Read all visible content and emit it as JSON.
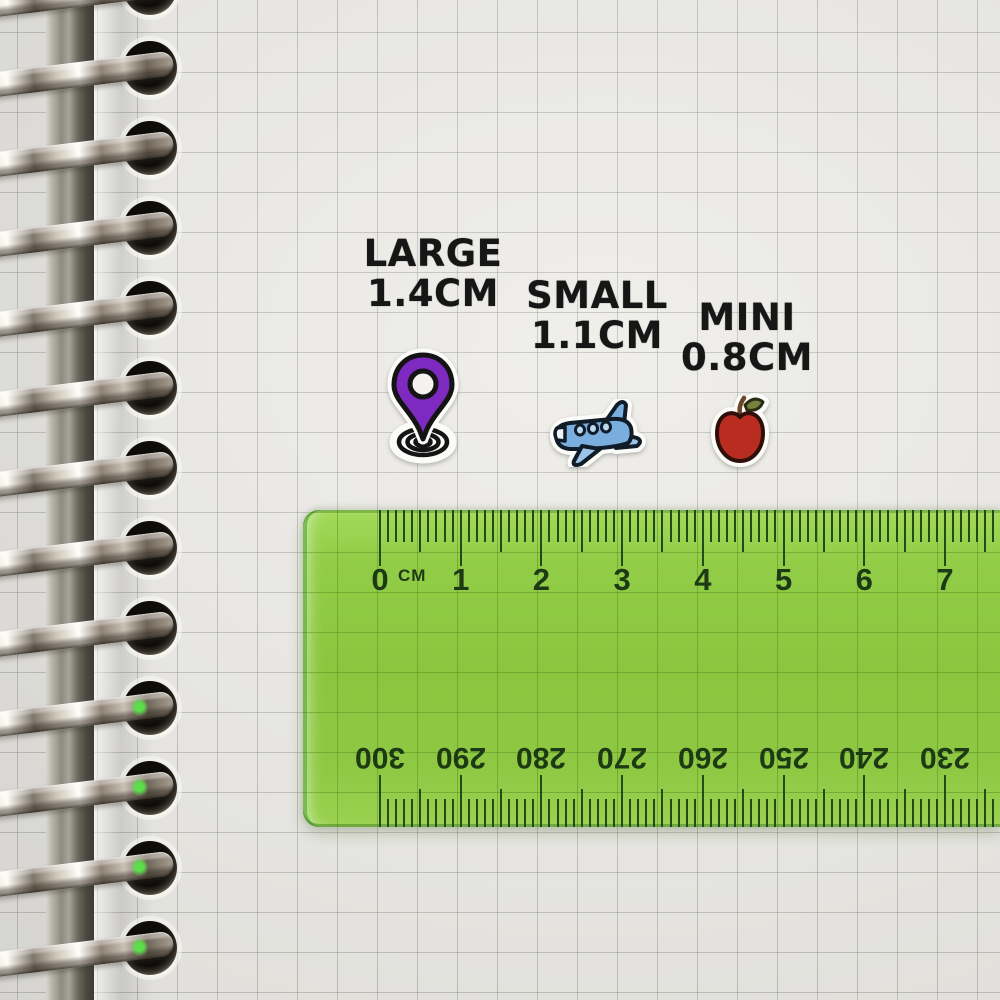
{
  "scene_title": "Sticker size comparison on squared notebook page with green ruler",
  "size_labels": [
    {
      "title": "LARGE",
      "size": "1.4CM"
    },
    {
      "title": "SMALL",
      "size": "1.1CM"
    },
    {
      "title": "MINI",
      "size": "0.8CM"
    }
  ],
  "stickers": [
    {
      "name": "location-pin",
      "color": "#7e2ac0"
    },
    {
      "name": "airplane",
      "color": "#79aede"
    },
    {
      "name": "apple",
      "color": "#b92d20"
    }
  ],
  "ruler": {
    "unit_label": "CM",
    "top_labels": [
      "0",
      "1",
      "2",
      "3",
      "4",
      "5",
      "6",
      "7"
    ],
    "bottom_labels": [
      "300",
      "290",
      "280",
      "270",
      "260",
      "250",
      "240",
      "230"
    ],
    "body_color": "#8cc63f",
    "marking_color": "#1d3a15"
  },
  "notebook": {
    "binding_ring_count": 13,
    "paper_color": "#ecebe7"
  }
}
